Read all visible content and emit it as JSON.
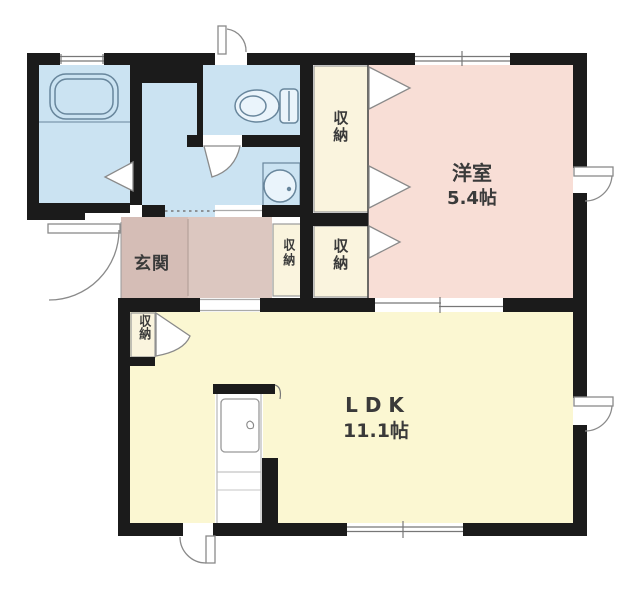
{
  "plan": {
    "type": "apartment-floorplan",
    "rooms": {
      "western_room": {
        "name": "洋室",
        "size": "5.4帖"
      },
      "ldk": {
        "name": "LDK",
        "size": "11.1帖"
      },
      "entrance": {
        "name": "玄関"
      },
      "storages": [
        {
          "label": "収納"
        },
        {
          "label": "収納"
        },
        {
          "label": "収納"
        },
        {
          "label": "収納"
        }
      ]
    },
    "fixtures": {
      "bathtub": "bathtub-icon",
      "toilet": "toilet-icon",
      "washbasin": "washbasin-icon",
      "service_door": "door-icon"
    },
    "colors": {
      "wall": "#1b1b1b",
      "wet_area": "#cbe3f2",
      "western_room": "#f8ded6",
      "ldk": "#fbf7d2",
      "genkan": "#d5bdb6",
      "hall": "#dcc7c0",
      "closet": "#faf4de",
      "fixture_line": "#68869c",
      "door_line": "#8a8a8a",
      "window_line": "#777777"
    }
  }
}
